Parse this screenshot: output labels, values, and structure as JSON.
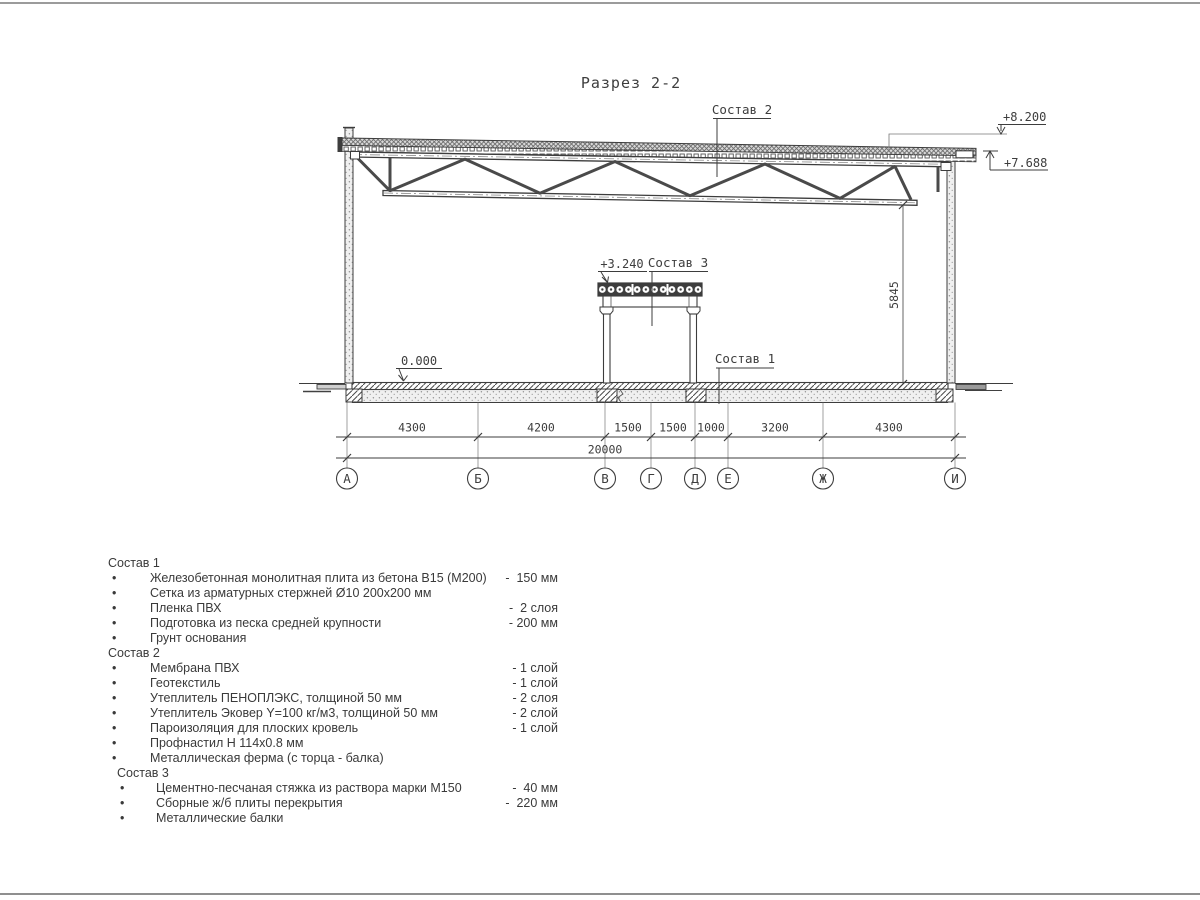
{
  "page": {
    "title": "Разрез 2-2"
  },
  "drawing": {
    "callouts": {
      "sostav1": "Состав 1",
      "sostav2": "Состав 2",
      "sostav3": "Состав 3"
    },
    "elevations": {
      "roof_top": "+8.200",
      "truss_bearing": "+7.688",
      "mezzanine": "+3.240",
      "floor": "0.000"
    },
    "height_dim": "5845",
    "dims": {
      "segments": [
        "4300",
        "4200",
        "1500",
        "1500",
        "1000",
        "3200",
        "4300"
      ],
      "total": "20000"
    },
    "axes": [
      "А",
      "Б",
      "В",
      "Г",
      "Д",
      "Е",
      "Ж",
      "И"
    ]
  },
  "legend": {
    "bullet": "•",
    "sections": [
      {
        "header": "Состав 1",
        "items": [
          {
            "name": "Железобетонная монолитная плита из бетона В15 (М200)",
            "value": "-  150 мм"
          },
          {
            "name": "Сетка из арматурных стержней Ø10 200х200 мм",
            "value": ""
          },
          {
            "name": "Пленка ПВХ",
            "value": "-  2 слоя"
          },
          {
            "name": "Подготовка из песка средней крупности",
            "value": "- 200 мм"
          },
          {
            "name": "Грунт основания",
            "value": ""
          }
        ]
      },
      {
        "header": "Состав 2",
        "items": [
          {
            "name": "Мембрана ПВХ",
            "value": "- 1 слой"
          },
          {
            "name": "Геотекстиль",
            "value": "- 1 слой"
          },
          {
            "name": "Утеплитель ПЕНОПЛЭКС, толщиной 50 мм",
            "value": "- 2 слоя"
          },
          {
            "name": "Утеплитель Эковер Y=100 кг/м3, толщиной 50 мм",
            "value": "- 2 слой"
          },
          {
            "name": "Пароизоляция для плоских кровель",
            "value": "- 1 слой"
          },
          {
            "name": "Профнастил Н 114х0.8 мм",
            "value": ""
          },
          {
            "name": "Металлическая ферма (с торца - балка)",
            "value": ""
          }
        ]
      },
      {
        "header": "Состав 3",
        "items": [
          {
            "name": "Цементно-песчаная стяжка из раствора марки М150",
            "value": "-  40 мм"
          },
          {
            "name": "Сборные ж/б плиты перекрытия",
            "value": "-  220 мм"
          },
          {
            "name": "Металлические балки",
            "value": ""
          }
        ]
      }
    ]
  },
  "colors": {
    "line": "#3d3d3d",
    "background": "#ffffff"
  }
}
